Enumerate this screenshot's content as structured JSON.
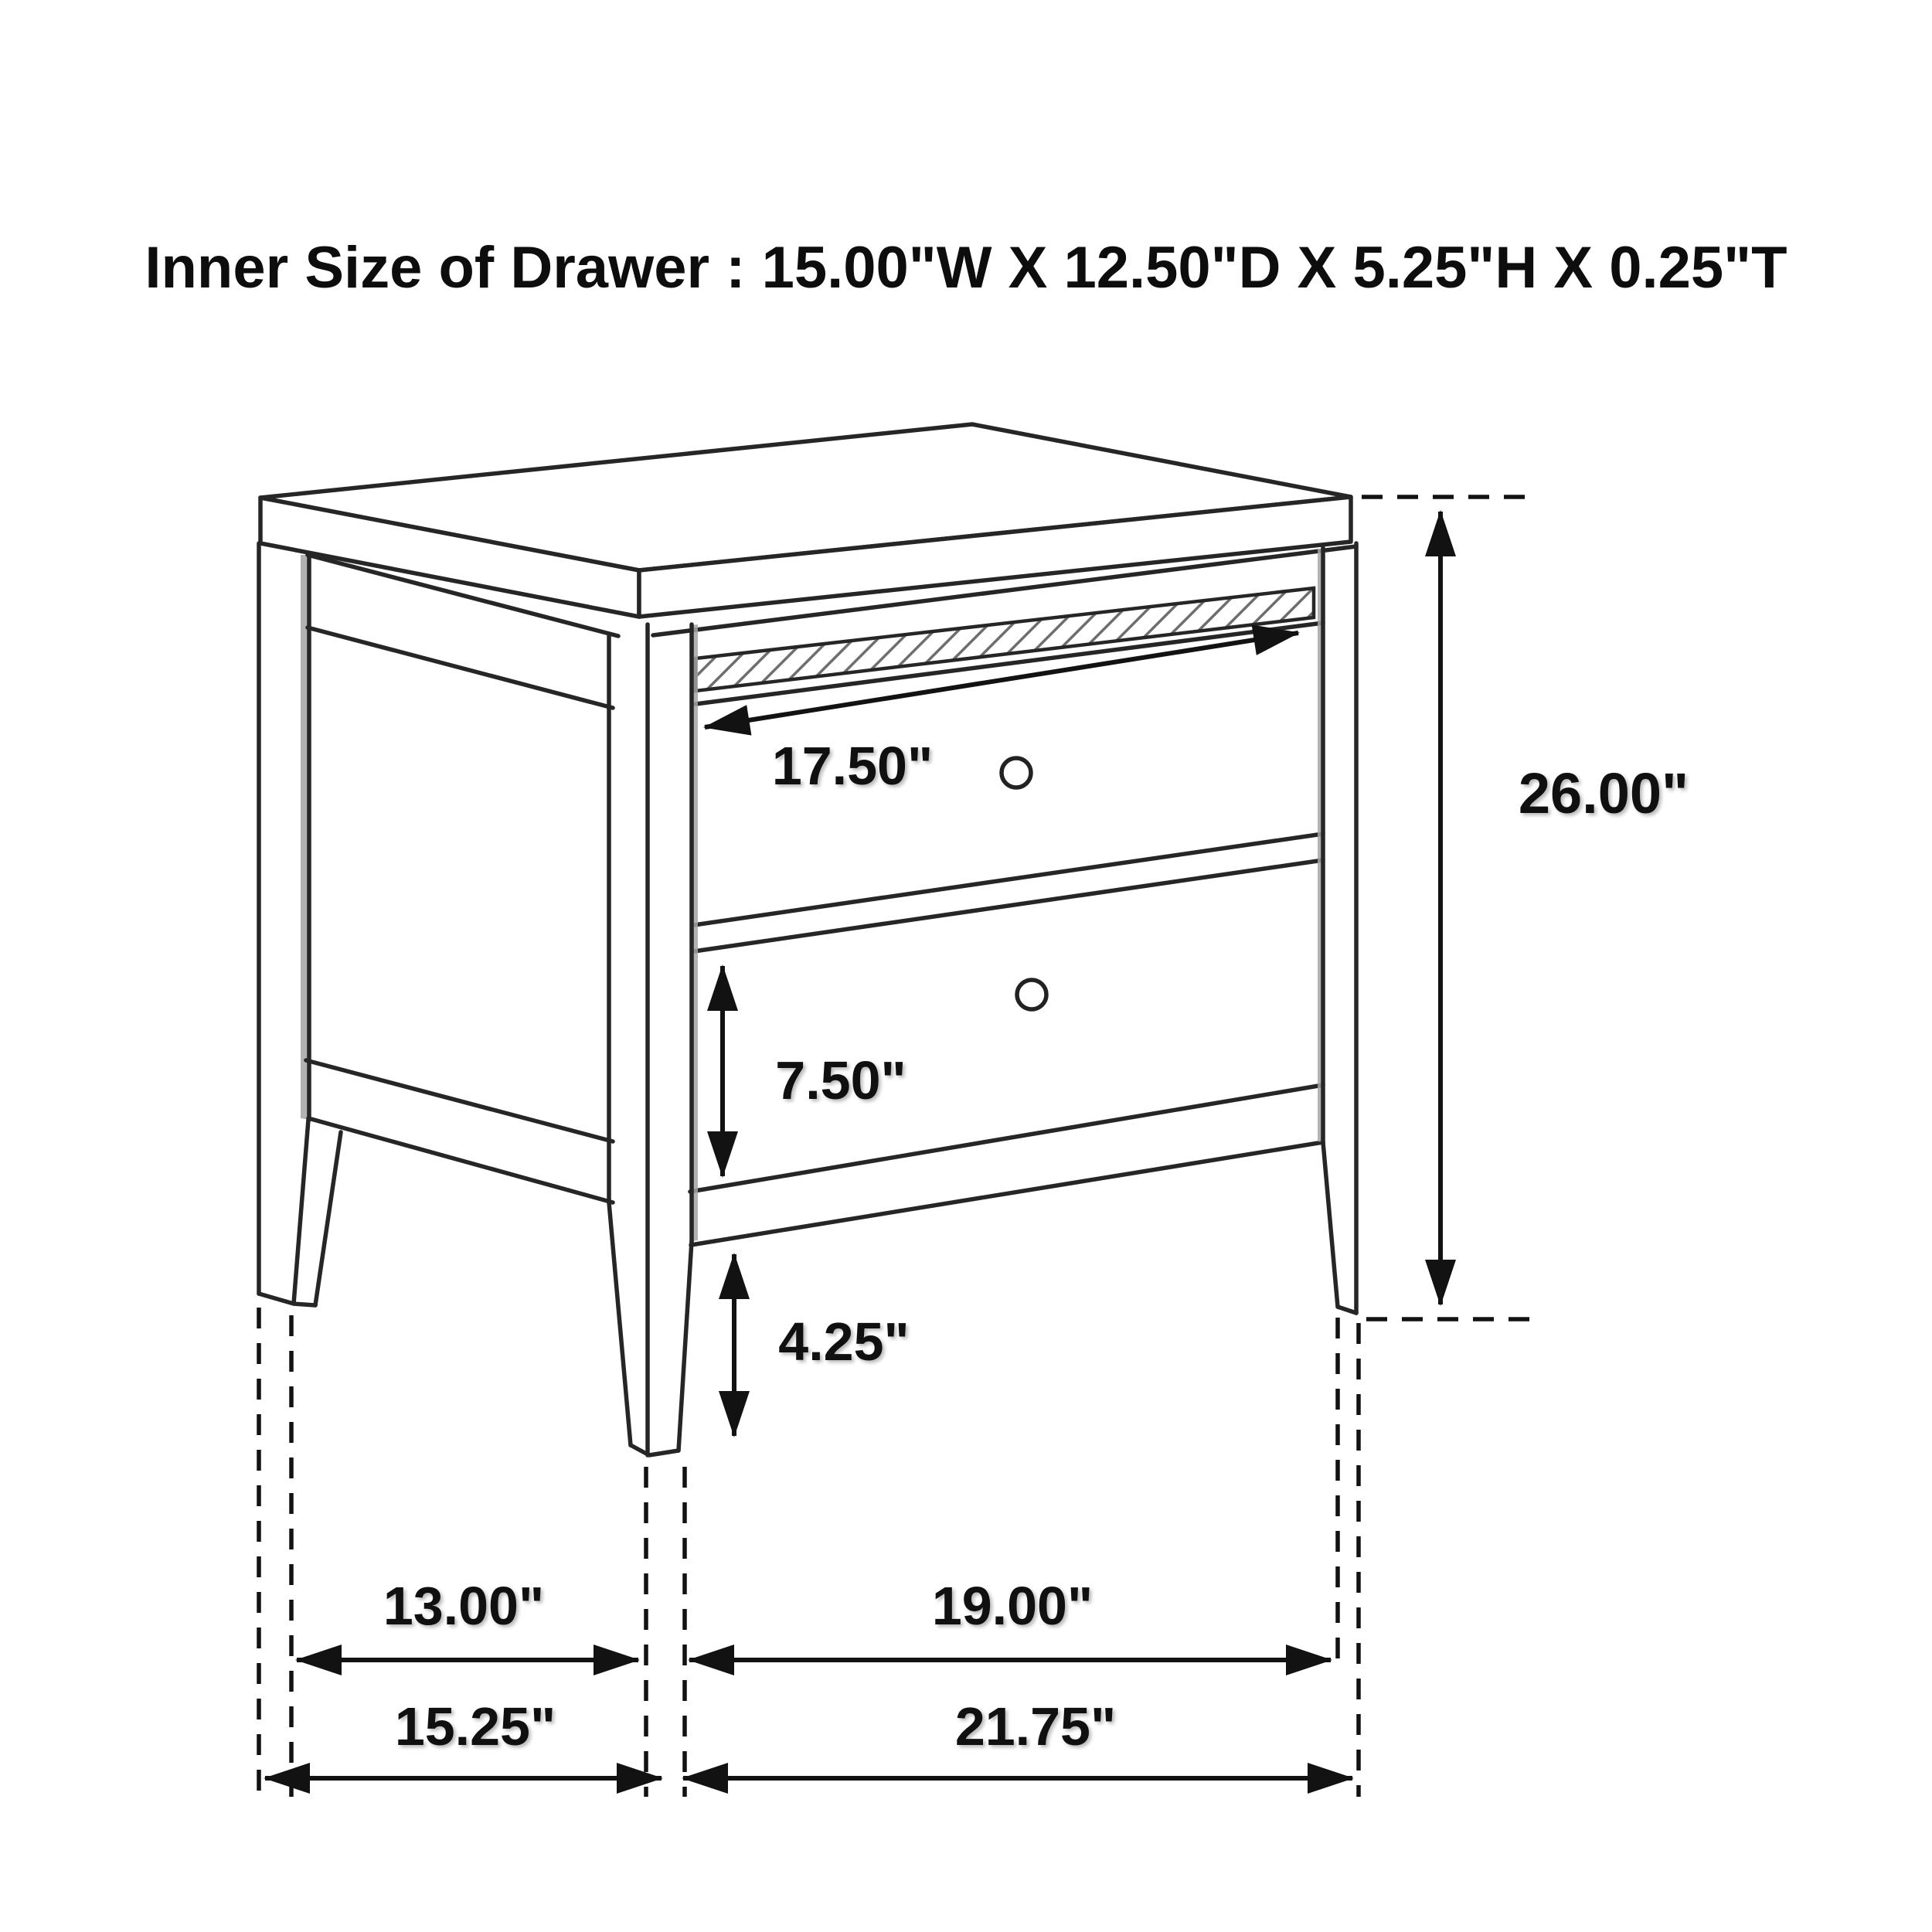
{
  "title": "Inner Size of Drawer : 15.00\"W X 12.50\"D X 5.25\"H X 0.25\"T",
  "object": "two-drawer nightstand technical line drawing",
  "colors": {
    "background": "#ffffff",
    "line": "#262626",
    "label": "#101010",
    "stile_shading": "#a4a4a4"
  },
  "labels": {
    "drawer_opening_width": "17.50\"",
    "drawer_front_height": "7.50\"",
    "leg_clearance_height": "4.25\"",
    "overall_height": "26.00\"",
    "side_inner_span": "13.00\"",
    "side_overall_depth": "15.25\"",
    "front_inner_span": "19.00\"",
    "front_overall_width": "21.75\""
  },
  "dimensions_list": [
    {
      "value": "17.50\"",
      "meaning": "drawer opening width",
      "orientation": "diagonal-along-front"
    },
    {
      "value": "7.50\"",
      "meaning": "lower drawer front height",
      "orientation": "vertical"
    },
    {
      "value": "4.25\"",
      "meaning": "floor to bottom rail clearance",
      "orientation": "vertical"
    },
    {
      "value": "26.00\"",
      "meaning": "overall height",
      "orientation": "vertical"
    },
    {
      "value": "13.00\"",
      "meaning": "inner span between side legs",
      "orientation": "horizontal"
    },
    {
      "value": "15.25\"",
      "meaning": "overall side depth",
      "orientation": "horizontal"
    },
    {
      "value": "19.00\"",
      "meaning": "inner span between front legs",
      "orientation": "horizontal"
    },
    {
      "value": "21.75\"",
      "meaning": "overall front width",
      "orientation": "horizontal"
    }
  ]
}
